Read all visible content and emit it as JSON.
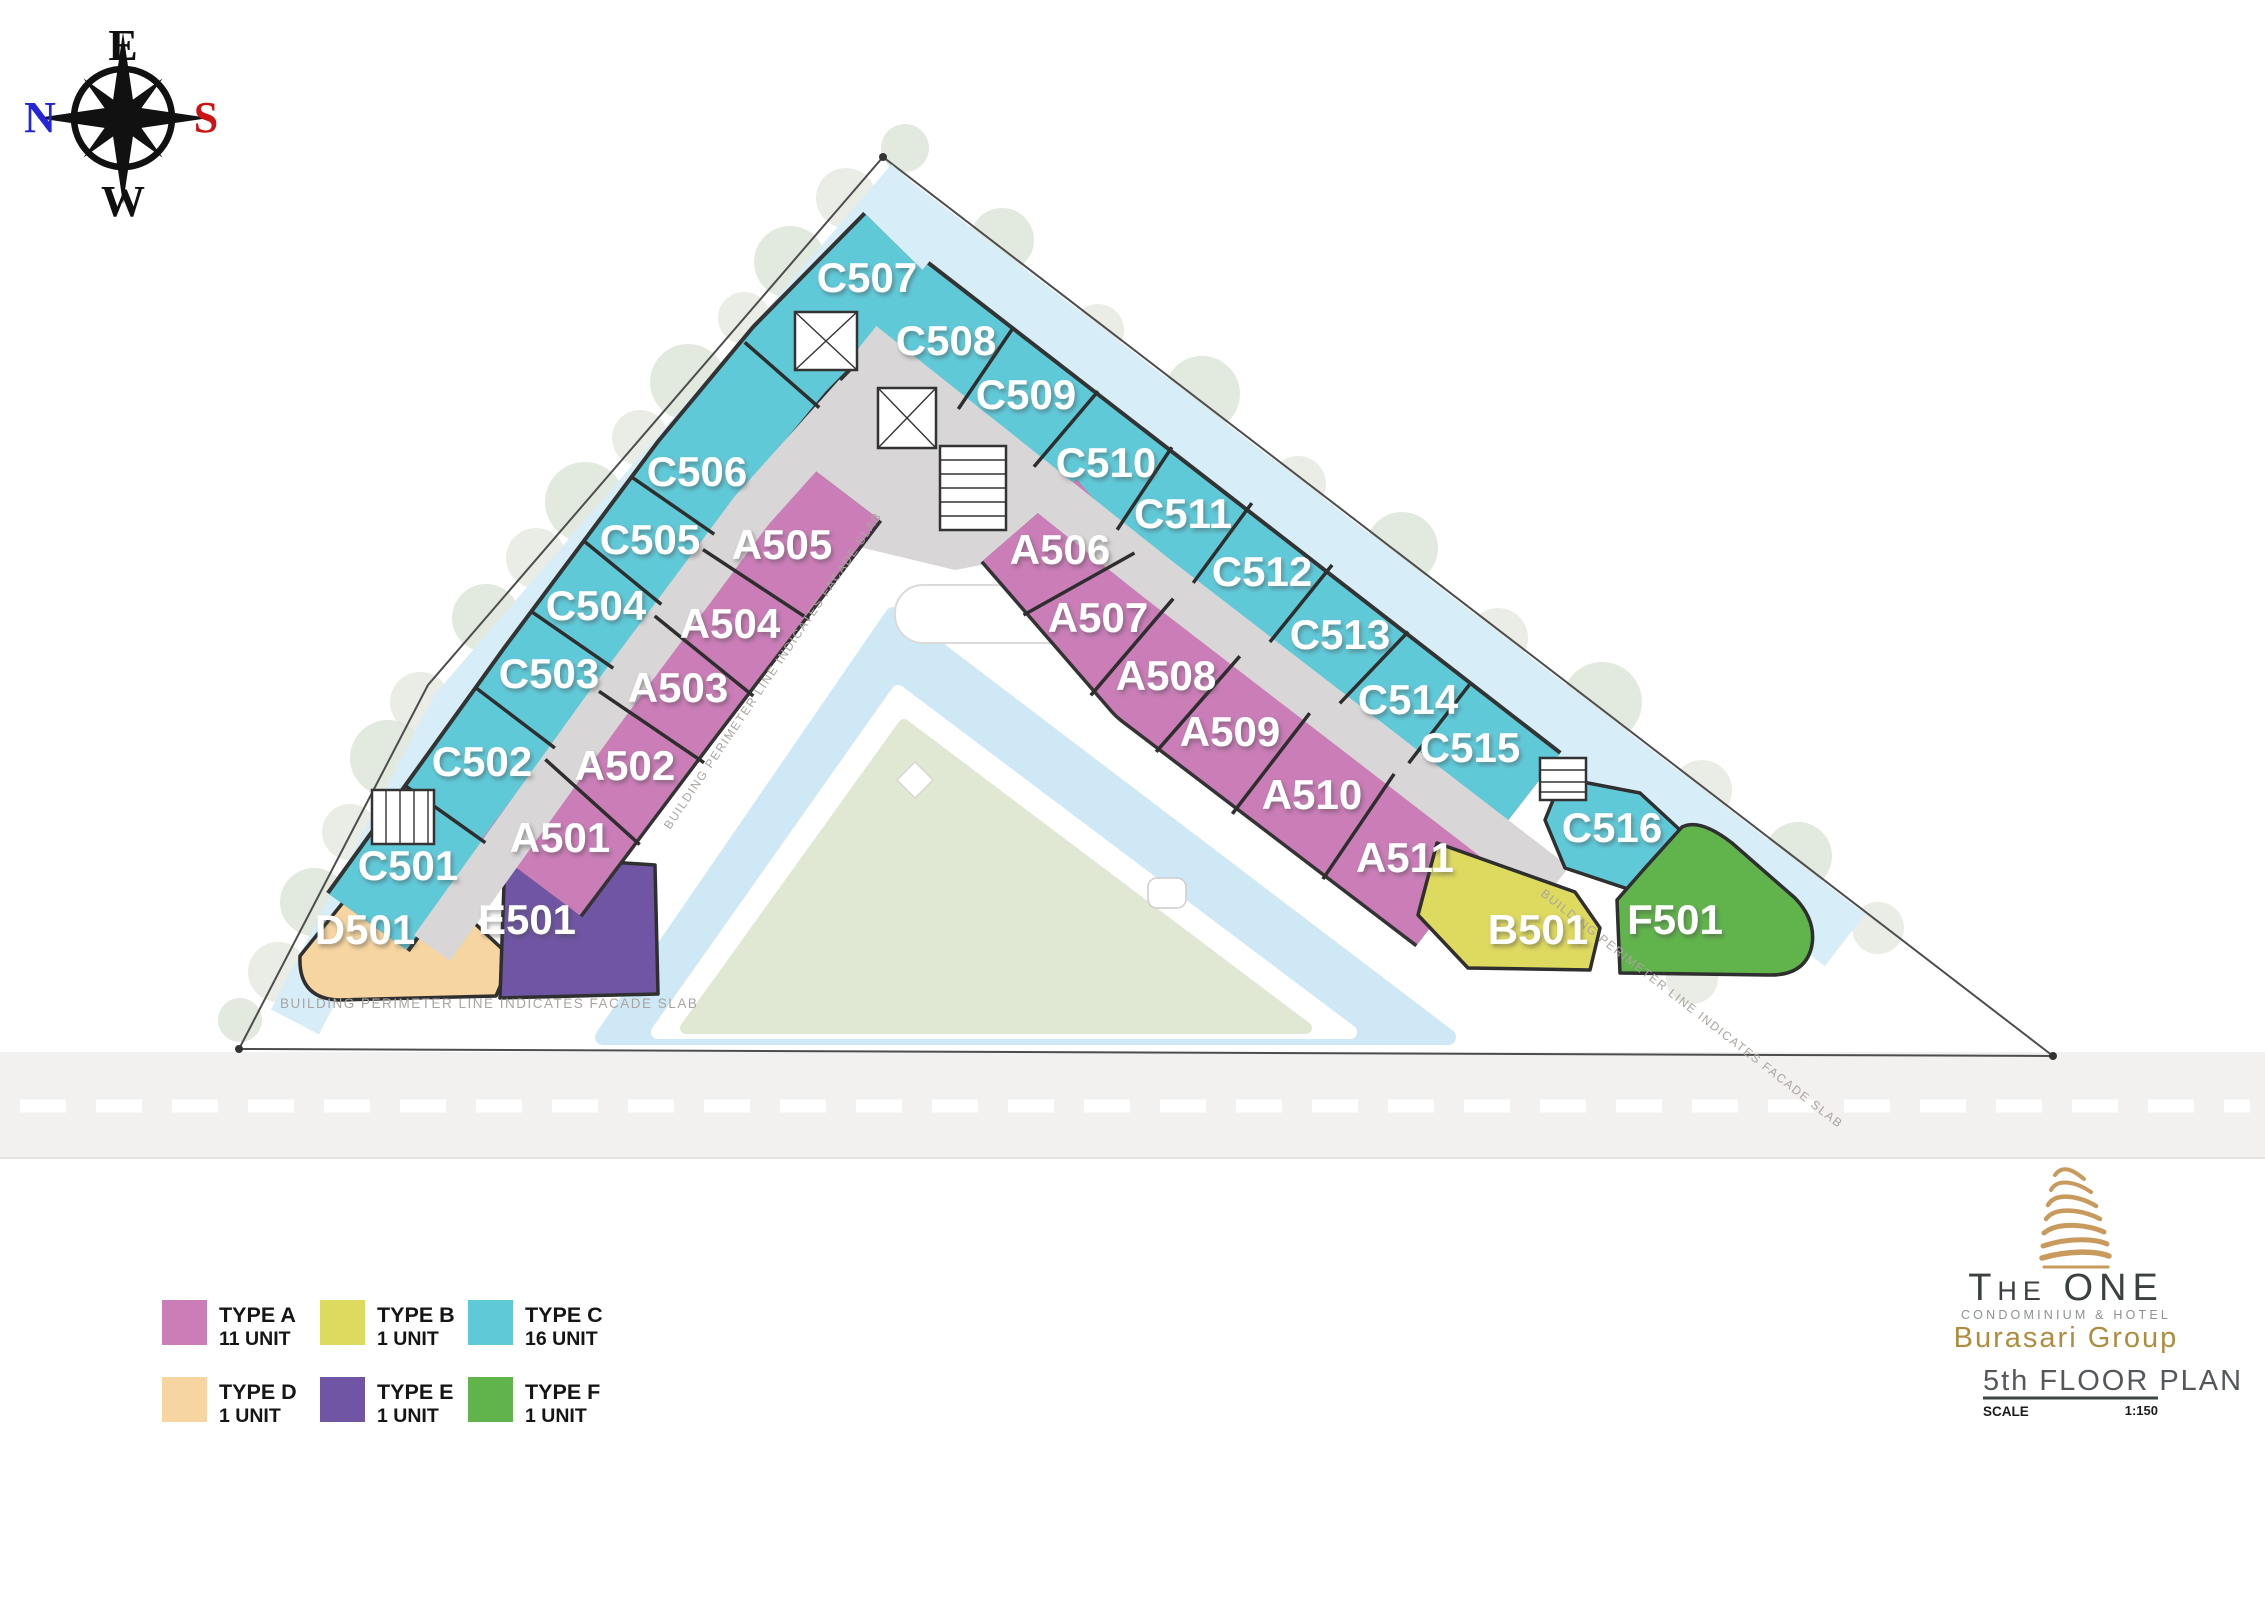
{
  "floor_plan": {
    "compass": {
      "east": "E",
      "north": "N",
      "south": "S",
      "west": "W",
      "east_color": "#101010",
      "north_color": "#2424d8",
      "south_color": "#cd1212",
      "west_color": "#101010"
    },
    "perimeter_note": "BUILDING PERIMETER LINE INDICATES FACADE SLAB",
    "types": {
      "A": {
        "color": "#ca7db7"
      },
      "B": {
        "color": "#ded95f"
      },
      "C": {
        "color": "#60c9d8"
      },
      "D": {
        "color": "#f6d5a0"
      },
      "E": {
        "color": "#6f55a3"
      },
      "F": {
        "color": "#61b34c"
      }
    },
    "units": [
      {
        "id": "C501",
        "type": "C",
        "band": "left-c",
        "x": 408,
        "y": 866
      },
      {
        "id": "C502",
        "type": "C",
        "band": "left-c",
        "x": 482,
        "y": 762
      },
      {
        "id": "C503",
        "type": "C",
        "band": "left-c",
        "x": 549,
        "y": 674
      },
      {
        "id": "C504",
        "type": "C",
        "band": "left-c",
        "x": 596,
        "y": 606
      },
      {
        "id": "C505",
        "type": "C",
        "band": "left-c",
        "x": 650,
        "y": 540
      },
      {
        "id": "C506",
        "type": "C",
        "band": "left-c",
        "x": 697,
        "y": 472
      },
      {
        "id": "C507",
        "type": "C",
        "band": "left-c",
        "x": 867,
        "y": 278
      },
      {
        "id": "C508",
        "type": "C",
        "band": "right-c",
        "x": 946,
        "y": 341
      },
      {
        "id": "C509",
        "type": "C",
        "band": "right-c",
        "x": 1026,
        "y": 395
      },
      {
        "id": "C510",
        "type": "C",
        "band": "right-c",
        "x": 1106,
        "y": 463
      },
      {
        "id": "C511",
        "type": "C",
        "band": "right-c",
        "x": 1183,
        "y": 514
      },
      {
        "id": "C512",
        "type": "C",
        "band": "right-c",
        "x": 1262,
        "y": 572
      },
      {
        "id": "C513",
        "type": "C",
        "band": "right-c",
        "x": 1340,
        "y": 635
      },
      {
        "id": "C514",
        "type": "C",
        "band": "right-c",
        "x": 1408,
        "y": 700
      },
      {
        "id": "C515",
        "type": "C",
        "band": "right-c",
        "x": 1470,
        "y": 748
      },
      {
        "id": "A501",
        "type": "A",
        "band": "left-a",
        "x": 560,
        "y": 838
      },
      {
        "id": "A502",
        "type": "A",
        "band": "left-a",
        "x": 625,
        "y": 766
      },
      {
        "id": "A503",
        "type": "A",
        "band": "left-a",
        "x": 678,
        "y": 688
      },
      {
        "id": "A504",
        "type": "A",
        "band": "left-a",
        "x": 730,
        "y": 624
      },
      {
        "id": "A505",
        "type": "A",
        "band": "left-a",
        "x": 782,
        "y": 545
      },
      {
        "id": "A506",
        "type": "A",
        "band": "right-a",
        "x": 1060,
        "y": 550
      },
      {
        "id": "A507",
        "type": "A",
        "band": "right-a",
        "x": 1098,
        "y": 618
      },
      {
        "id": "A508",
        "type": "A",
        "band": "right-a",
        "x": 1166,
        "y": 676
      },
      {
        "id": "A509",
        "type": "A",
        "band": "right-a",
        "x": 1230,
        "y": 732
      },
      {
        "id": "A510",
        "type": "A",
        "band": "right-a",
        "x": 1312,
        "y": 795
      },
      {
        "id": "A511",
        "type": "A",
        "band": "right-a",
        "x": 1405,
        "y": 858
      },
      {
        "id": "C516",
        "type": "C",
        "band": "corner",
        "x": 1612,
        "y": 828
      },
      {
        "id": "D501",
        "type": "D",
        "band": "corner",
        "x": 365,
        "y": 930
      },
      {
        "id": "E501",
        "type": "E",
        "band": "corner",
        "x": 527,
        "y": 920
      },
      {
        "id": "B501",
        "type": "B",
        "band": "corner",
        "x": 1538,
        "y": 930
      },
      {
        "id": "F501",
        "type": "F",
        "band": "corner",
        "x": 1675,
        "y": 920
      }
    ]
  },
  "legend": {
    "items": [
      {
        "label": "TYPE A",
        "count": "11 UNIT",
        "type": "A"
      },
      {
        "label": "TYPE B",
        "count": "1 UNIT",
        "type": "B"
      },
      {
        "label": "TYPE C",
        "count": "16 UNIT",
        "type": "C"
      },
      {
        "label": "TYPE D",
        "count": "1 UNIT",
        "type": "D"
      },
      {
        "label": "TYPE E",
        "count": "1 UNIT",
        "type": "E"
      },
      {
        "label": "TYPE F",
        "count": "1 UNIT",
        "type": "F"
      }
    ]
  },
  "logo": {
    "brand": "The ONE",
    "subtitle": "CONDOMINIUM & HOTEL",
    "group": "Burasari Group"
  },
  "title_block": {
    "floor": "5th FLOOR PLAN",
    "scale_label": "SCALE",
    "scale_value": "1:150"
  }
}
